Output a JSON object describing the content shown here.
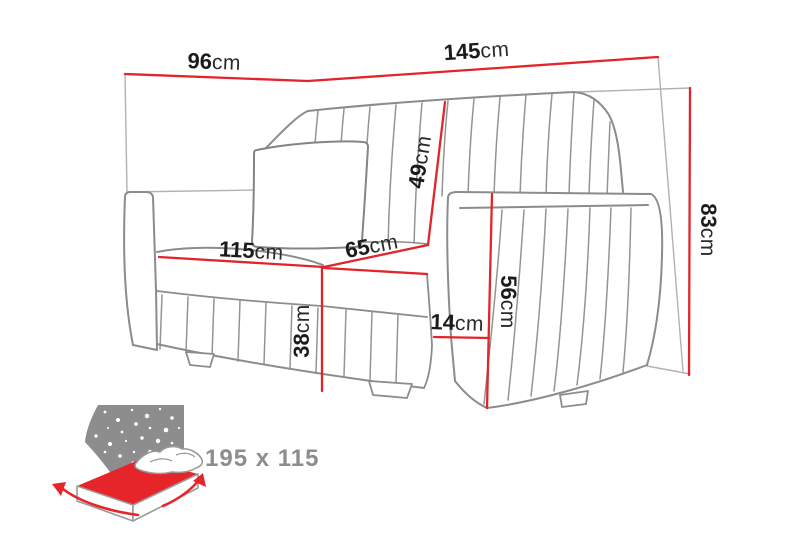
{
  "diagram": {
    "type": "sofa-dimension-drawing",
    "colors": {
      "dimension_line": "#e2242b",
      "sofa_outline": "#8c8c8c",
      "bounding_box": "#b2b2b2",
      "label_text": "#1b1b1b",
      "icon_gray": "#8d8d8d",
      "icon_red": "#e6252b"
    },
    "dimensions": [
      {
        "name": "back-width-left",
        "value": "96",
        "unit": "cm"
      },
      {
        "name": "back-width-right",
        "value": "145",
        "unit": "cm"
      },
      {
        "name": "total-height",
        "value": "83",
        "unit": "cm"
      },
      {
        "name": "backrest-height",
        "value": "49",
        "unit": "cm"
      },
      {
        "name": "seat-width",
        "value": "115",
        "unit": "cm"
      },
      {
        "name": "seat-depth",
        "value": "65",
        "unit": "cm"
      },
      {
        "name": "seat-height",
        "value": "38",
        "unit": "cm"
      },
      {
        "name": "armrest-height",
        "value": "56",
        "unit": "cm"
      },
      {
        "name": "armrest-width",
        "value": "14",
        "unit": "cm"
      }
    ],
    "sleeping_function": {
      "size_label": "195 x 115"
    }
  }
}
